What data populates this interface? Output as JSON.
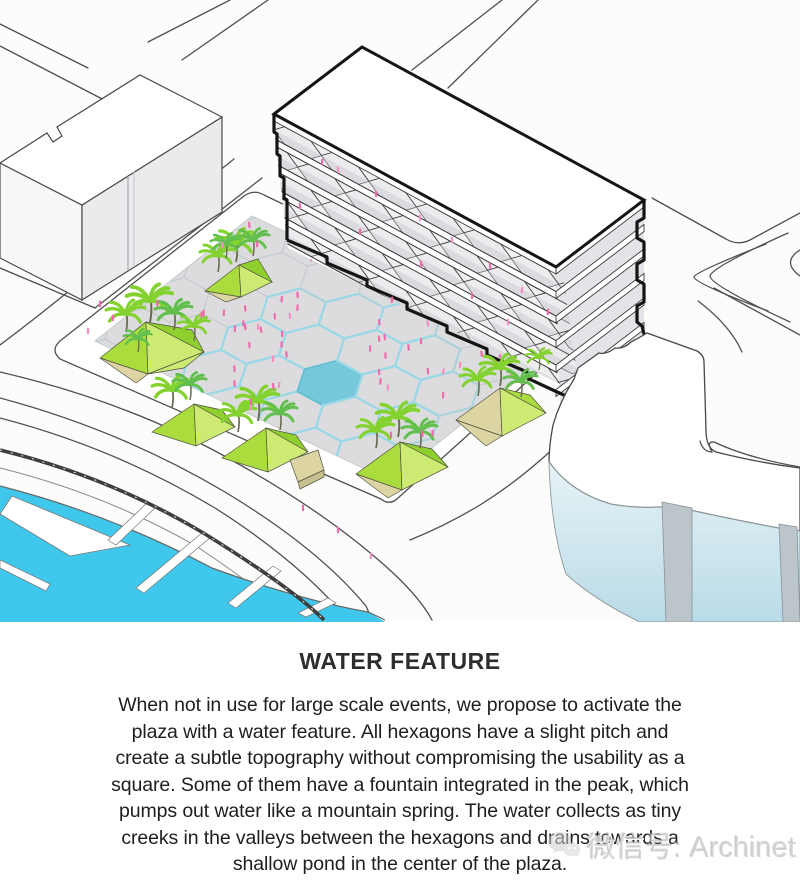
{
  "illustration": {
    "label": "Isometric site diagram: hexagon plaza with central pond, faceted planters with palm trees, slab building, marina and surrounding streets",
    "colors": {
      "marina_water": "#3fc8ec",
      "pond": "#74c8da",
      "creek": "#9ad8e6",
      "grid_line": "#c3cacd",
      "plaza_paving": "#dcdcde",
      "planter_light": "#cdeb72",
      "planter_mid": "#aadc3e",
      "planter_dark": "#8fcf2e",
      "planter_tan": "#ddd4a4",
      "palm_bright": "#84d22f",
      "palm_dark": "#62bf4e",
      "people_pink": "#ee6bae",
      "road_line": "#4f4f4f",
      "building_face": "#ececee",
      "building_shadow": "#d6d6d9",
      "glass": "#cfe4ec",
      "fin": "#bcc6ca"
    }
  },
  "caption": {
    "title": "WATER FEATURE",
    "body_lines": [
      "When not in use for large scale events, we propose to activate the",
      "plaza with a water feature. All hexagons have a slight pitch and",
      "create a subtle topography without compromising the usability as a",
      "square. Some of them have a fountain integrated in the peak, which",
      "pumps out water like a mountain spring. The water collects as tiny",
      "creeks in the valleys between the hexagons and drains towards a",
      "shallow pond in the center of the plaza."
    ]
  },
  "watermark": {
    "text": "微信号: Archinet",
    "icon": "wechat-icon"
  }
}
